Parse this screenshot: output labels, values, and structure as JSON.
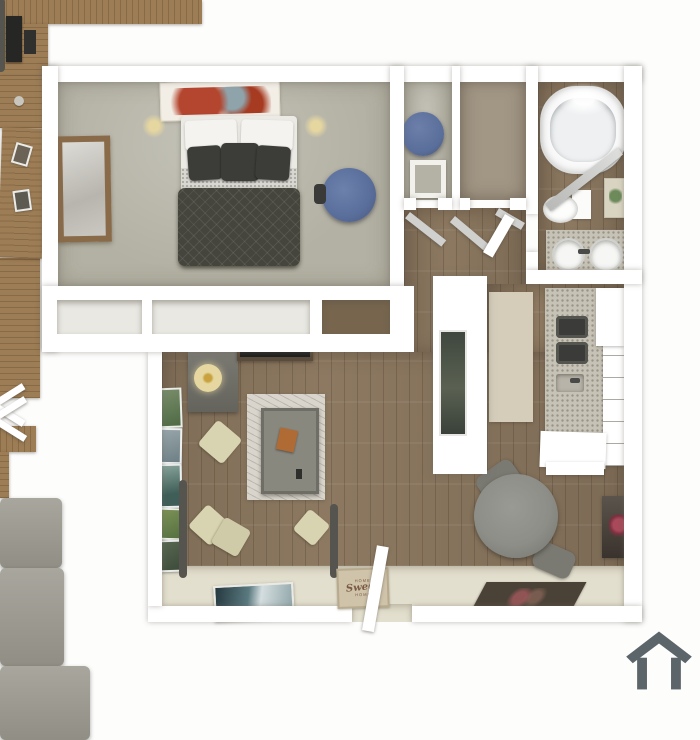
{
  "meta": {
    "description": "3D top-down rendered floor plan of a one-bedroom apartment",
    "visible_text_items": 3
  },
  "doormat": {
    "top": "HOME",
    "script": "Sweet",
    "bottom": "HOME"
  },
  "watermark": {
    "icon": "house-icon",
    "color": "#5c6569"
  },
  "rooms": {
    "bedroom": {
      "furniture": [
        "wall-art",
        "headboard",
        "nightstand-left",
        "nightstand-right",
        "bed",
        "dark-pillows",
        "quilted-blanket",
        "wall-mirror",
        "dresser",
        "desk",
        "monitor",
        "office-chair",
        "closet-double-doors"
      ]
    },
    "closet_row": {
      "furniture": [
        "closet-cell-1",
        "closet-cell-2",
        "closet-cell-3"
      ]
    },
    "walk_in_closet": {
      "furniture": [
        "blue-pouf",
        "picture-frame"
      ]
    },
    "storage_closet": {
      "furniture": [
        "wood-box",
        "closet-organizer"
      ]
    },
    "bathroom": {
      "furniture": [
        "bathtub",
        "shower-curtain",
        "toilet",
        "plant-art",
        "double-sink-vanity",
        "ceiling-light"
      ]
    },
    "hallway": {
      "furniture": [
        "sliding-doors",
        "bathroom-door"
      ]
    },
    "kitchen": {
      "furniture": [
        "partition-wall",
        "tall-art",
        "runner-rug",
        "granite-counter",
        "stove-burners",
        "sink",
        "cabinets",
        "end-cabinet"
      ]
    },
    "dining": {
      "furniture": [
        "round-table",
        "chair",
        "chair",
        "flower-art",
        "dark-rug"
      ]
    },
    "living": {
      "furniture": [
        "gallery-wall",
        "side-table",
        "table-lamp",
        "tv-console",
        "tv",
        "armchair",
        "marble-rug",
        "coffee-table",
        "orange-book",
        "sofa-chaise",
        "sofa",
        "throw-pillows",
        "leaning-wave-art"
      ]
    },
    "entry": {
      "furniture": [
        "open-front-door",
        "welcome-mat"
      ]
    }
  },
  "palette": {
    "bg": "#fdfdfc",
    "wall": "#ffffff",
    "carpet": "#b3b1a3",
    "wood": "#8d7961",
    "wood_dark": "#6f5d49",
    "cream_floor": "#e3dfce",
    "runner_rug": "#d5cdba",
    "marble_rug": "#d9d5cc",
    "sofa": "#9c9a90",
    "sofa_frame": "#55544e",
    "pillow_cream": "#d8d3b0",
    "blanket": "#45453d",
    "pillow_dark": "#3c3c39",
    "sheet": "#eceae4",
    "wood_furn": "#9d7d55",
    "blue_seat": "#5a6e9b",
    "granite": "#c7c2b6",
    "curtain": "#c7c7c5",
    "tub": "#eef0f1",
    "art_red": "#b4452e",
    "art_green": "#6d8a5b",
    "dining_table": "#8e8e88",
    "dark_rug": "#4b4237",
    "doormat_bg": "#cfc3aa",
    "doormat_text": "#7b5a45",
    "watermark": "#5c6569",
    "tv": "#1f1f1f",
    "lamp": "#e6d7a0"
  }
}
